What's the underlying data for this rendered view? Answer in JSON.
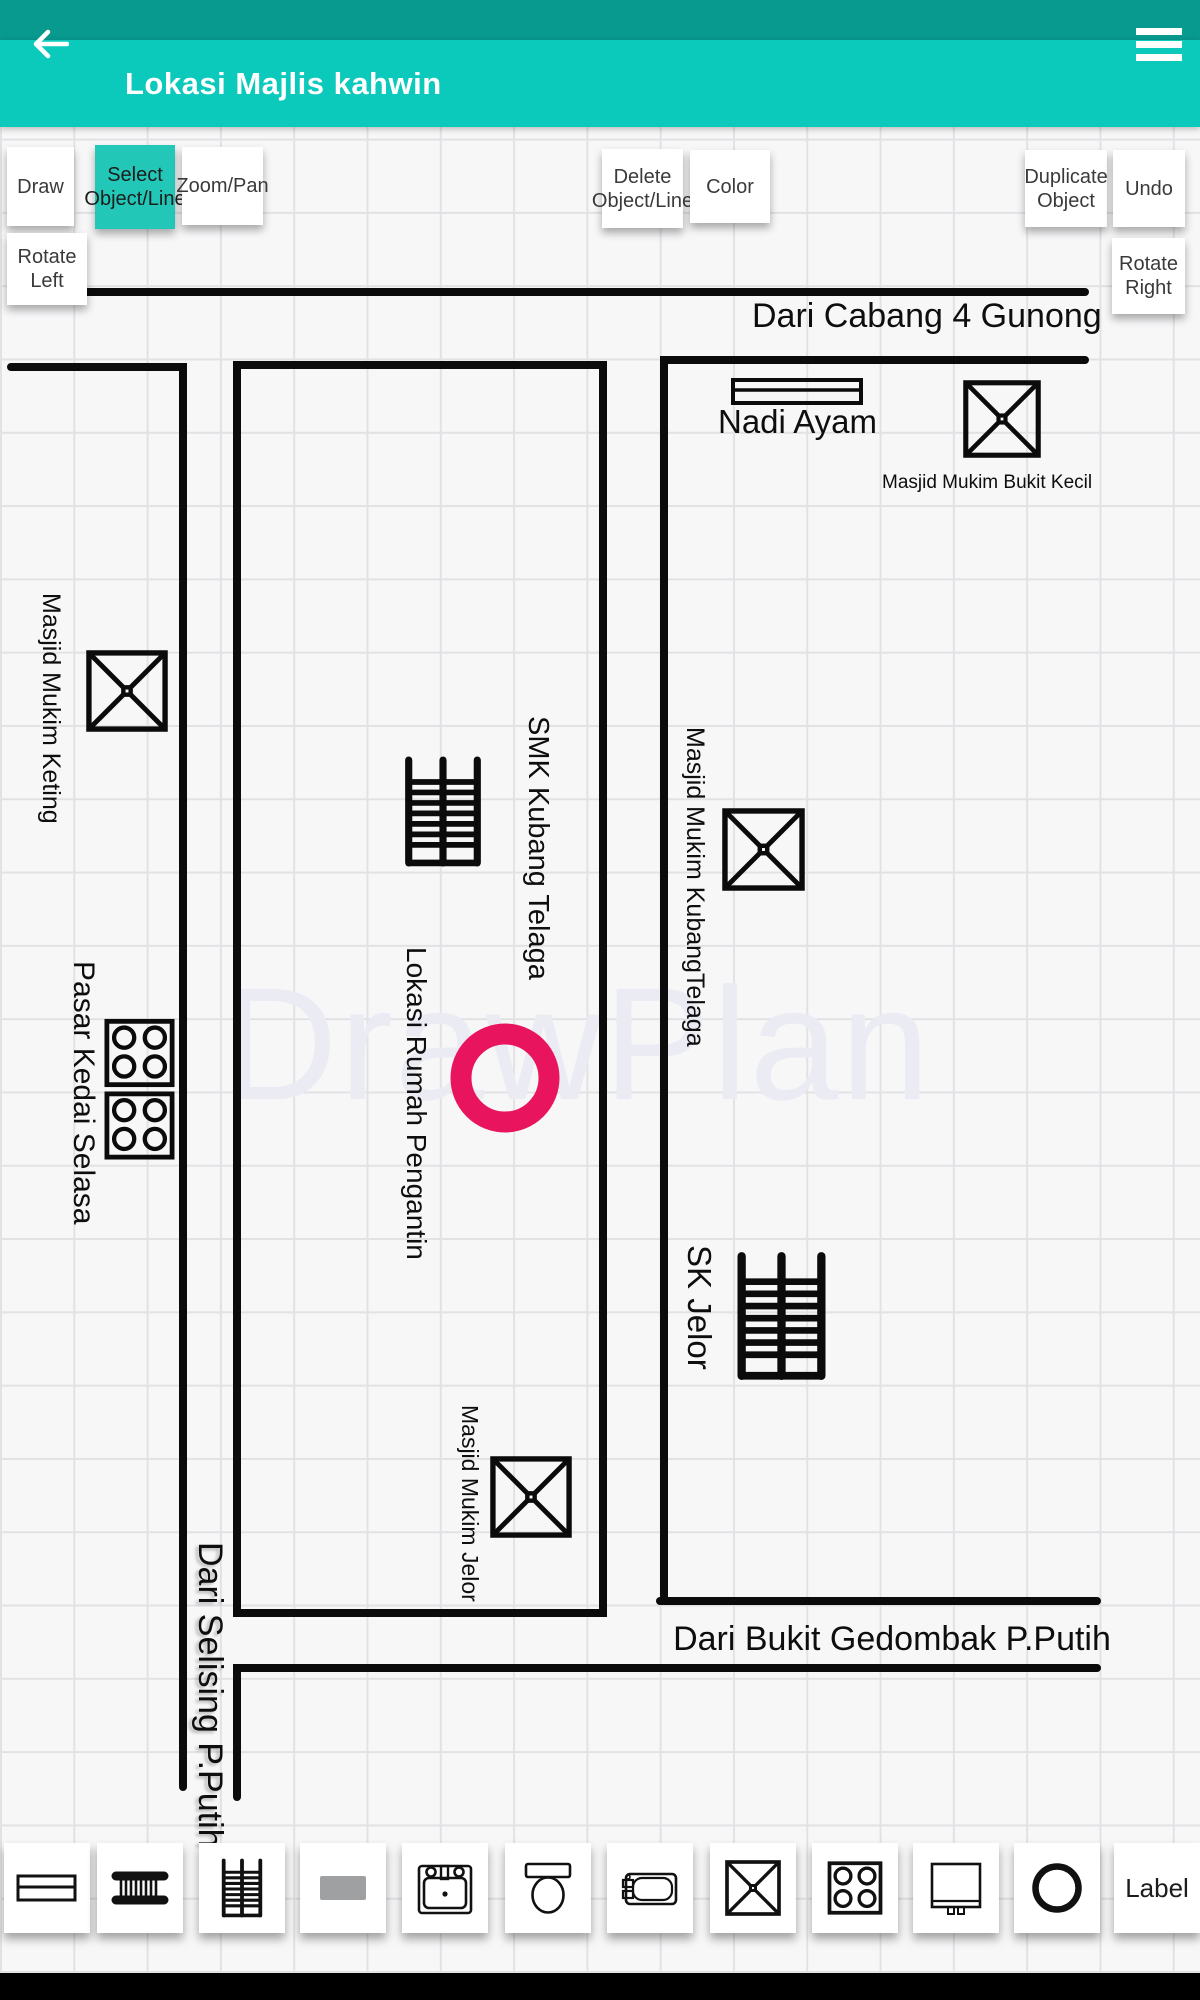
{
  "header": {
    "title": "Lokasi Majlis kahwin"
  },
  "toolbar": {
    "draw": "Draw",
    "select_object_line": "Select Object/Line",
    "zoom_pan": "Zoom/Pan",
    "delete_object_line": "Delete Object/Line",
    "color": "Color",
    "duplicate_object": "Duplicate Object",
    "undo": "Undo",
    "rotate_left": "Rotate Left",
    "rotate_right": "Rotate Right"
  },
  "canvas": {
    "watermark": "DrawPlan",
    "labels": {
      "road_top": "Dari Cabang 4 Gunong",
      "road_bottom": "Dari Bukit Gedombak P.Putih",
      "road_left": "Dari Selising P.Putih",
      "nadi_ayam": "Nadi Ayam",
      "masjid_bukit_kecil": "Masjid Mukim Bukit Kecil",
      "masjid_keting": "Masjid Mukim Keting",
      "smk_kubang_telaga": "SMK Kubang Telaga",
      "masjid_kubang_telaga": "Masjid Mukim KubangTelaga",
      "lokasi_rumah_pengantin": "Lokasi Rumah Pengantin",
      "pasar_kedai_selasa": "Pasar Kedai Selasa",
      "sk_jelor": "SK Jelor",
      "masjid_jelor": "Masjid Mukim Jelor"
    }
  },
  "palette": {
    "items": [
      "table",
      "ladder",
      "staircase",
      "rectangle",
      "sink",
      "toilet",
      "bathtub",
      "masjid",
      "stove",
      "cabinet",
      "circle"
    ],
    "label_button": "Label"
  },
  "colors": {
    "status_bar": "#089a8e",
    "app_bar": "#0bc9bb",
    "selected_button": "#22c7b8",
    "marker_pink": "#e8155e",
    "line_black": "#0b0b0b"
  }
}
